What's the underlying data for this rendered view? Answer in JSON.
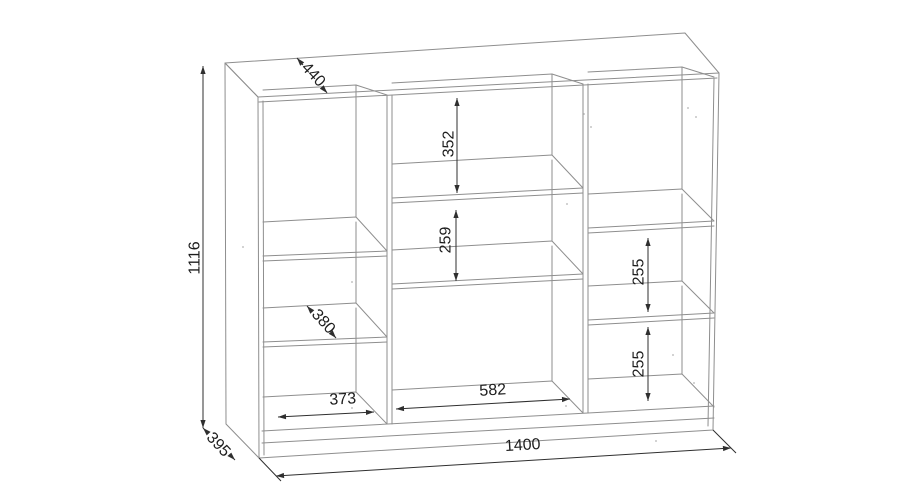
{
  "drawing": {
    "type": "furniture-technical-drawing",
    "colors": {
      "background": "#ffffff",
      "cabinet_edge": "#8e8e8e",
      "dimension_line": "#2f2f2f",
      "dimension_text": "#1d1d1d"
    },
    "dimensions": {
      "top_depth": "440",
      "overall_height": "1116",
      "middle_top_compartment_height": "352",
      "middle_second_compartment_height": "259",
      "right_middle_compartment_height": "255",
      "right_bottom_compartment_height": "255",
      "left_shelf_depth": "380",
      "left_compartment_width": "373",
      "middle_compartment_width": "582",
      "overall_width": "1400",
      "bottom_depth": "395"
    }
  }
}
